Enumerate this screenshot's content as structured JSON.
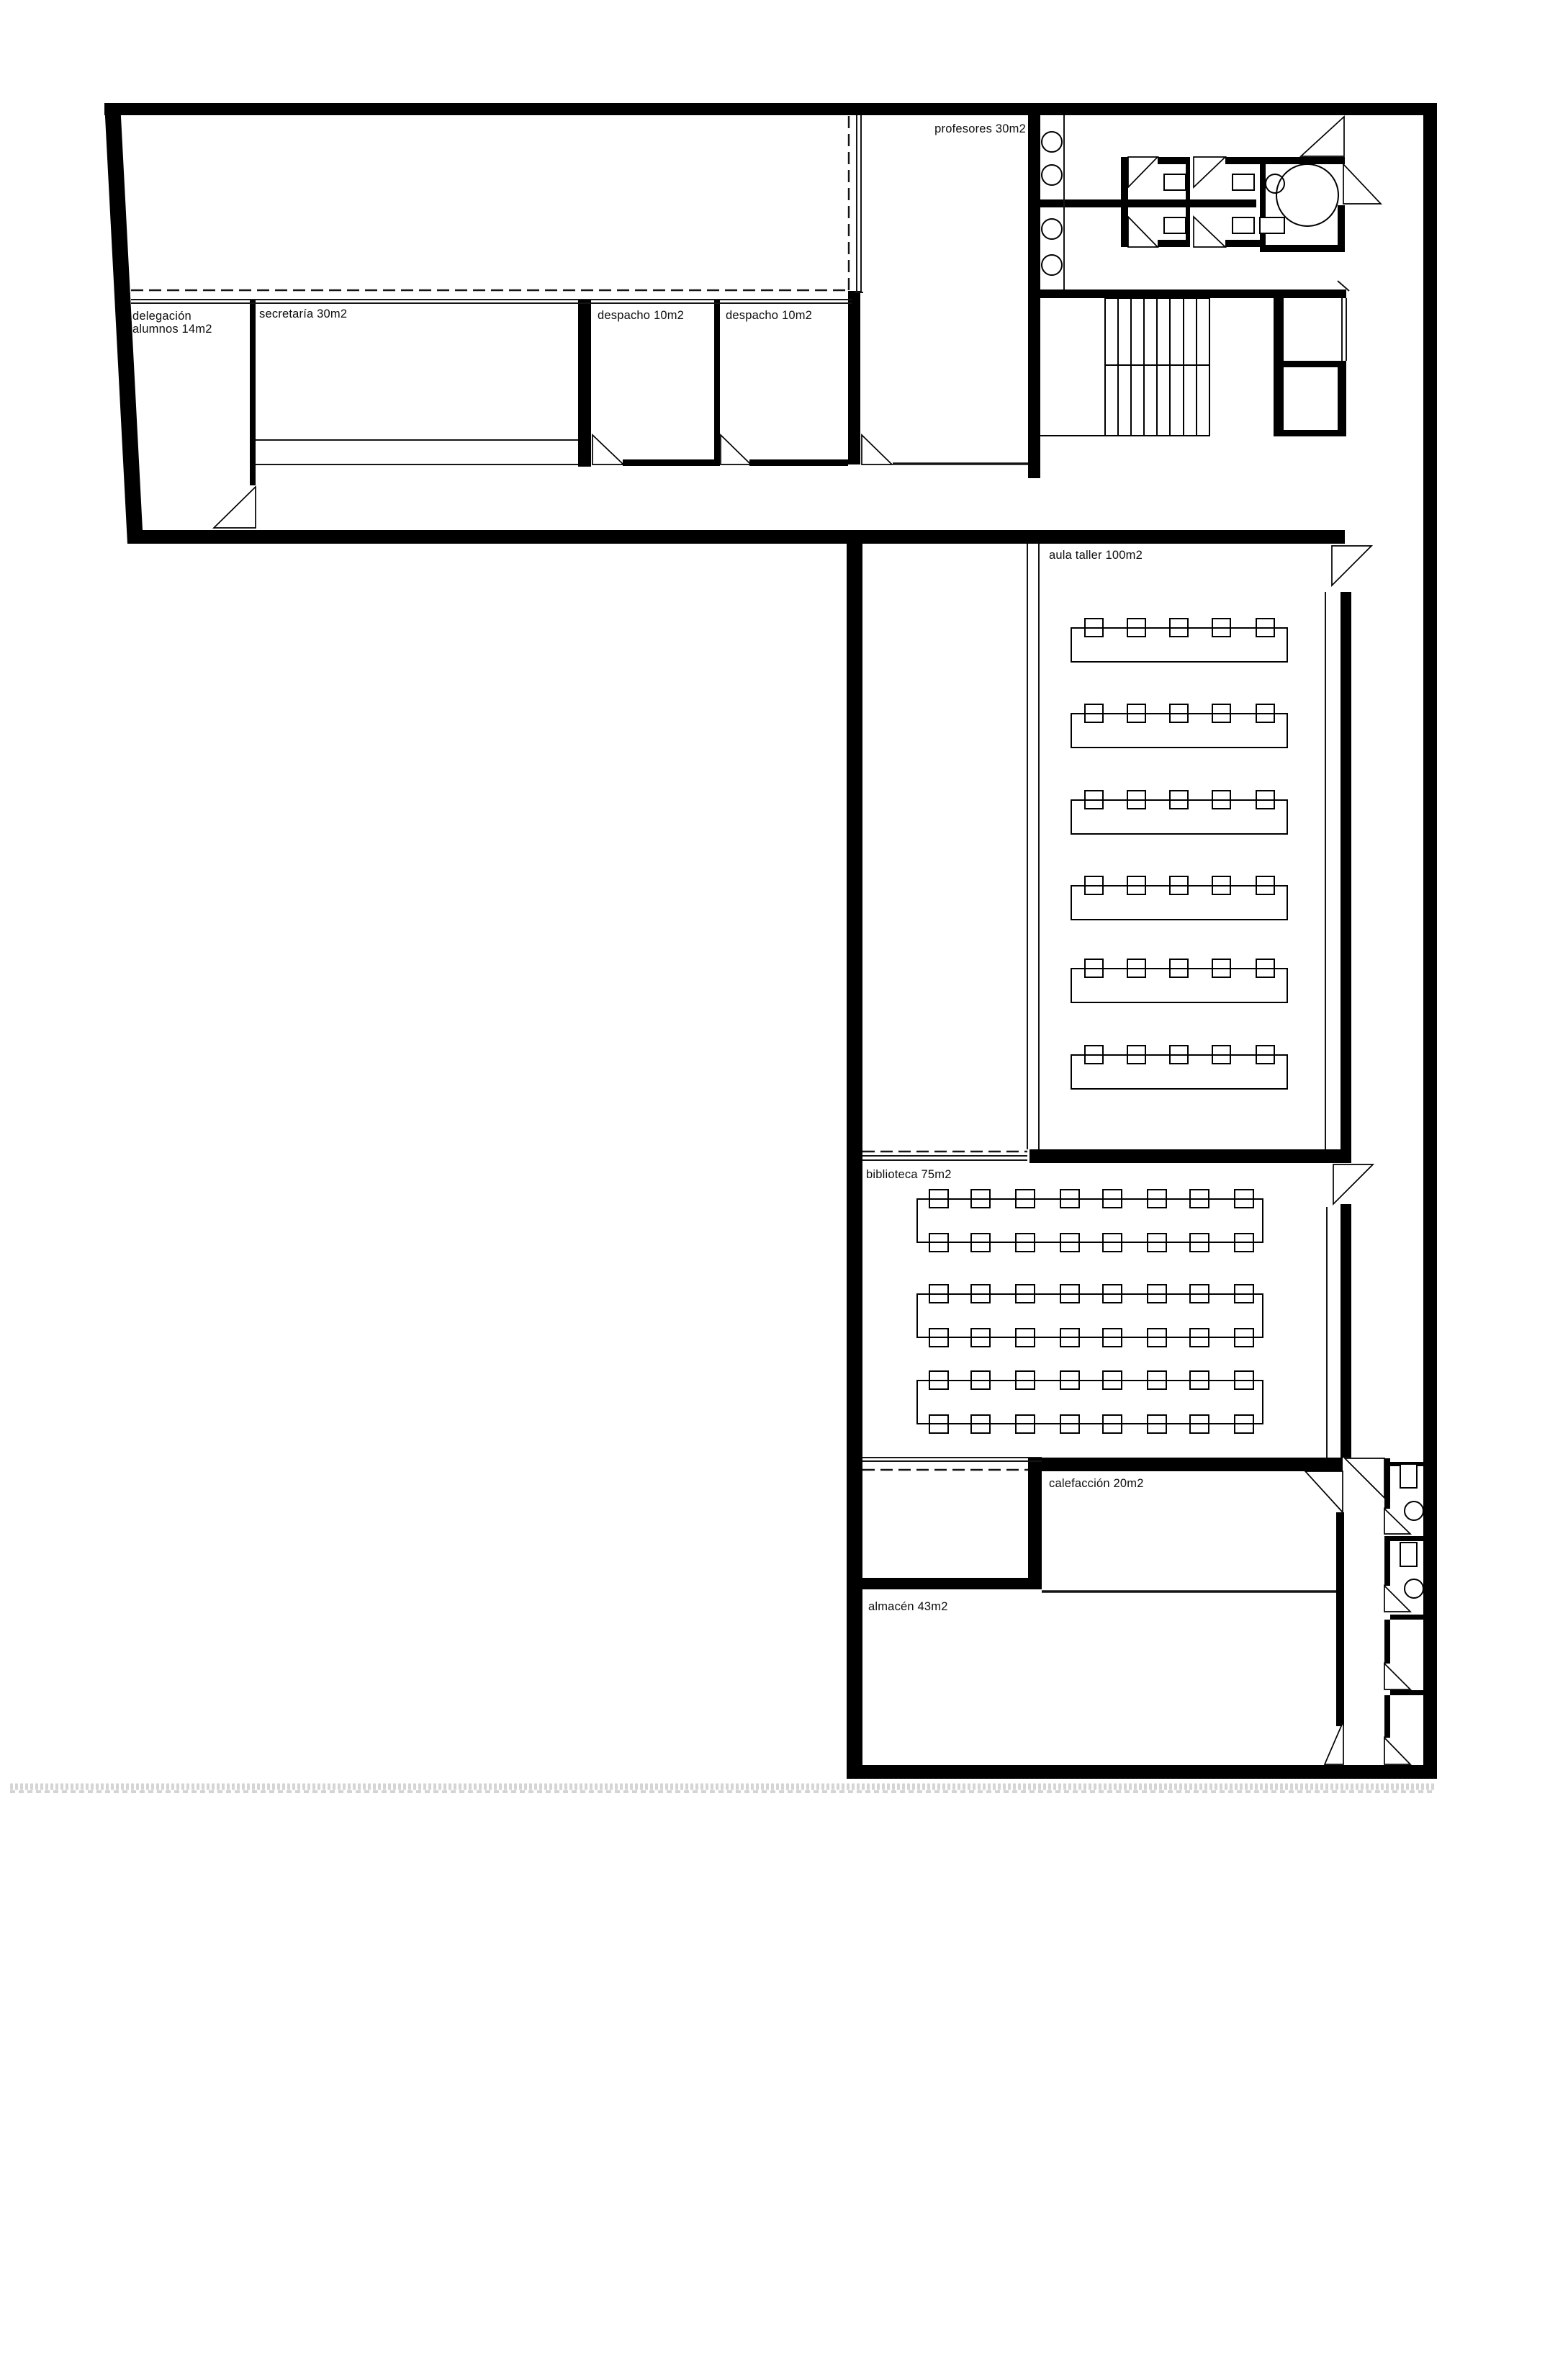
{
  "document": {
    "kind": "architectural floor plan",
    "style": "black and white CAD line drawing on white paper",
    "language": "Spanish"
  },
  "colors": {
    "ink": "#000000",
    "paper": "#ffffff",
    "scan_noise": "#c7c7c7"
  },
  "rooms": [
    {
      "id": "delegacion-alumnos",
      "label_line1": "delegación",
      "label_line2": "alumnos 14m2",
      "area_m2": 14
    },
    {
      "id": "secretaria",
      "label": "secretaría 30m2",
      "area_m2": 30
    },
    {
      "id": "despacho-1",
      "label": "despacho 10m2",
      "area_m2": 10
    },
    {
      "id": "despacho-2",
      "label": "despacho 10m2",
      "area_m2": 10
    },
    {
      "id": "profesores",
      "label": "profesores 30m2",
      "area_m2": 30
    },
    {
      "id": "aula-taller",
      "label": "aula taller 100m2",
      "area_m2": 100
    },
    {
      "id": "biblioteca",
      "label": "biblioteca 75m2",
      "area_m2": 75
    },
    {
      "id": "calefaccion",
      "label": "calefacción 20m2",
      "area_m2": 20
    },
    {
      "id": "almacen",
      "label": "almacén 43m2",
      "area_m2": 43
    }
  ],
  "furniture": {
    "aula_taller": {
      "workbench_rows": 6,
      "stools_per_row": 5
    },
    "biblioteca": {
      "tables": 3,
      "chairs_per_table": 16
    },
    "aseos_norte": {
      "sinks": 4,
      "wc_cabins": 4,
      "accessible_wc": 1
    },
    "aseos_este": {
      "wc_cabins": 4,
      "cabins_with_fixtures": 2
    },
    "stairs": {
      "flights": 2,
      "treads_per_flight": 8
    }
  }
}
